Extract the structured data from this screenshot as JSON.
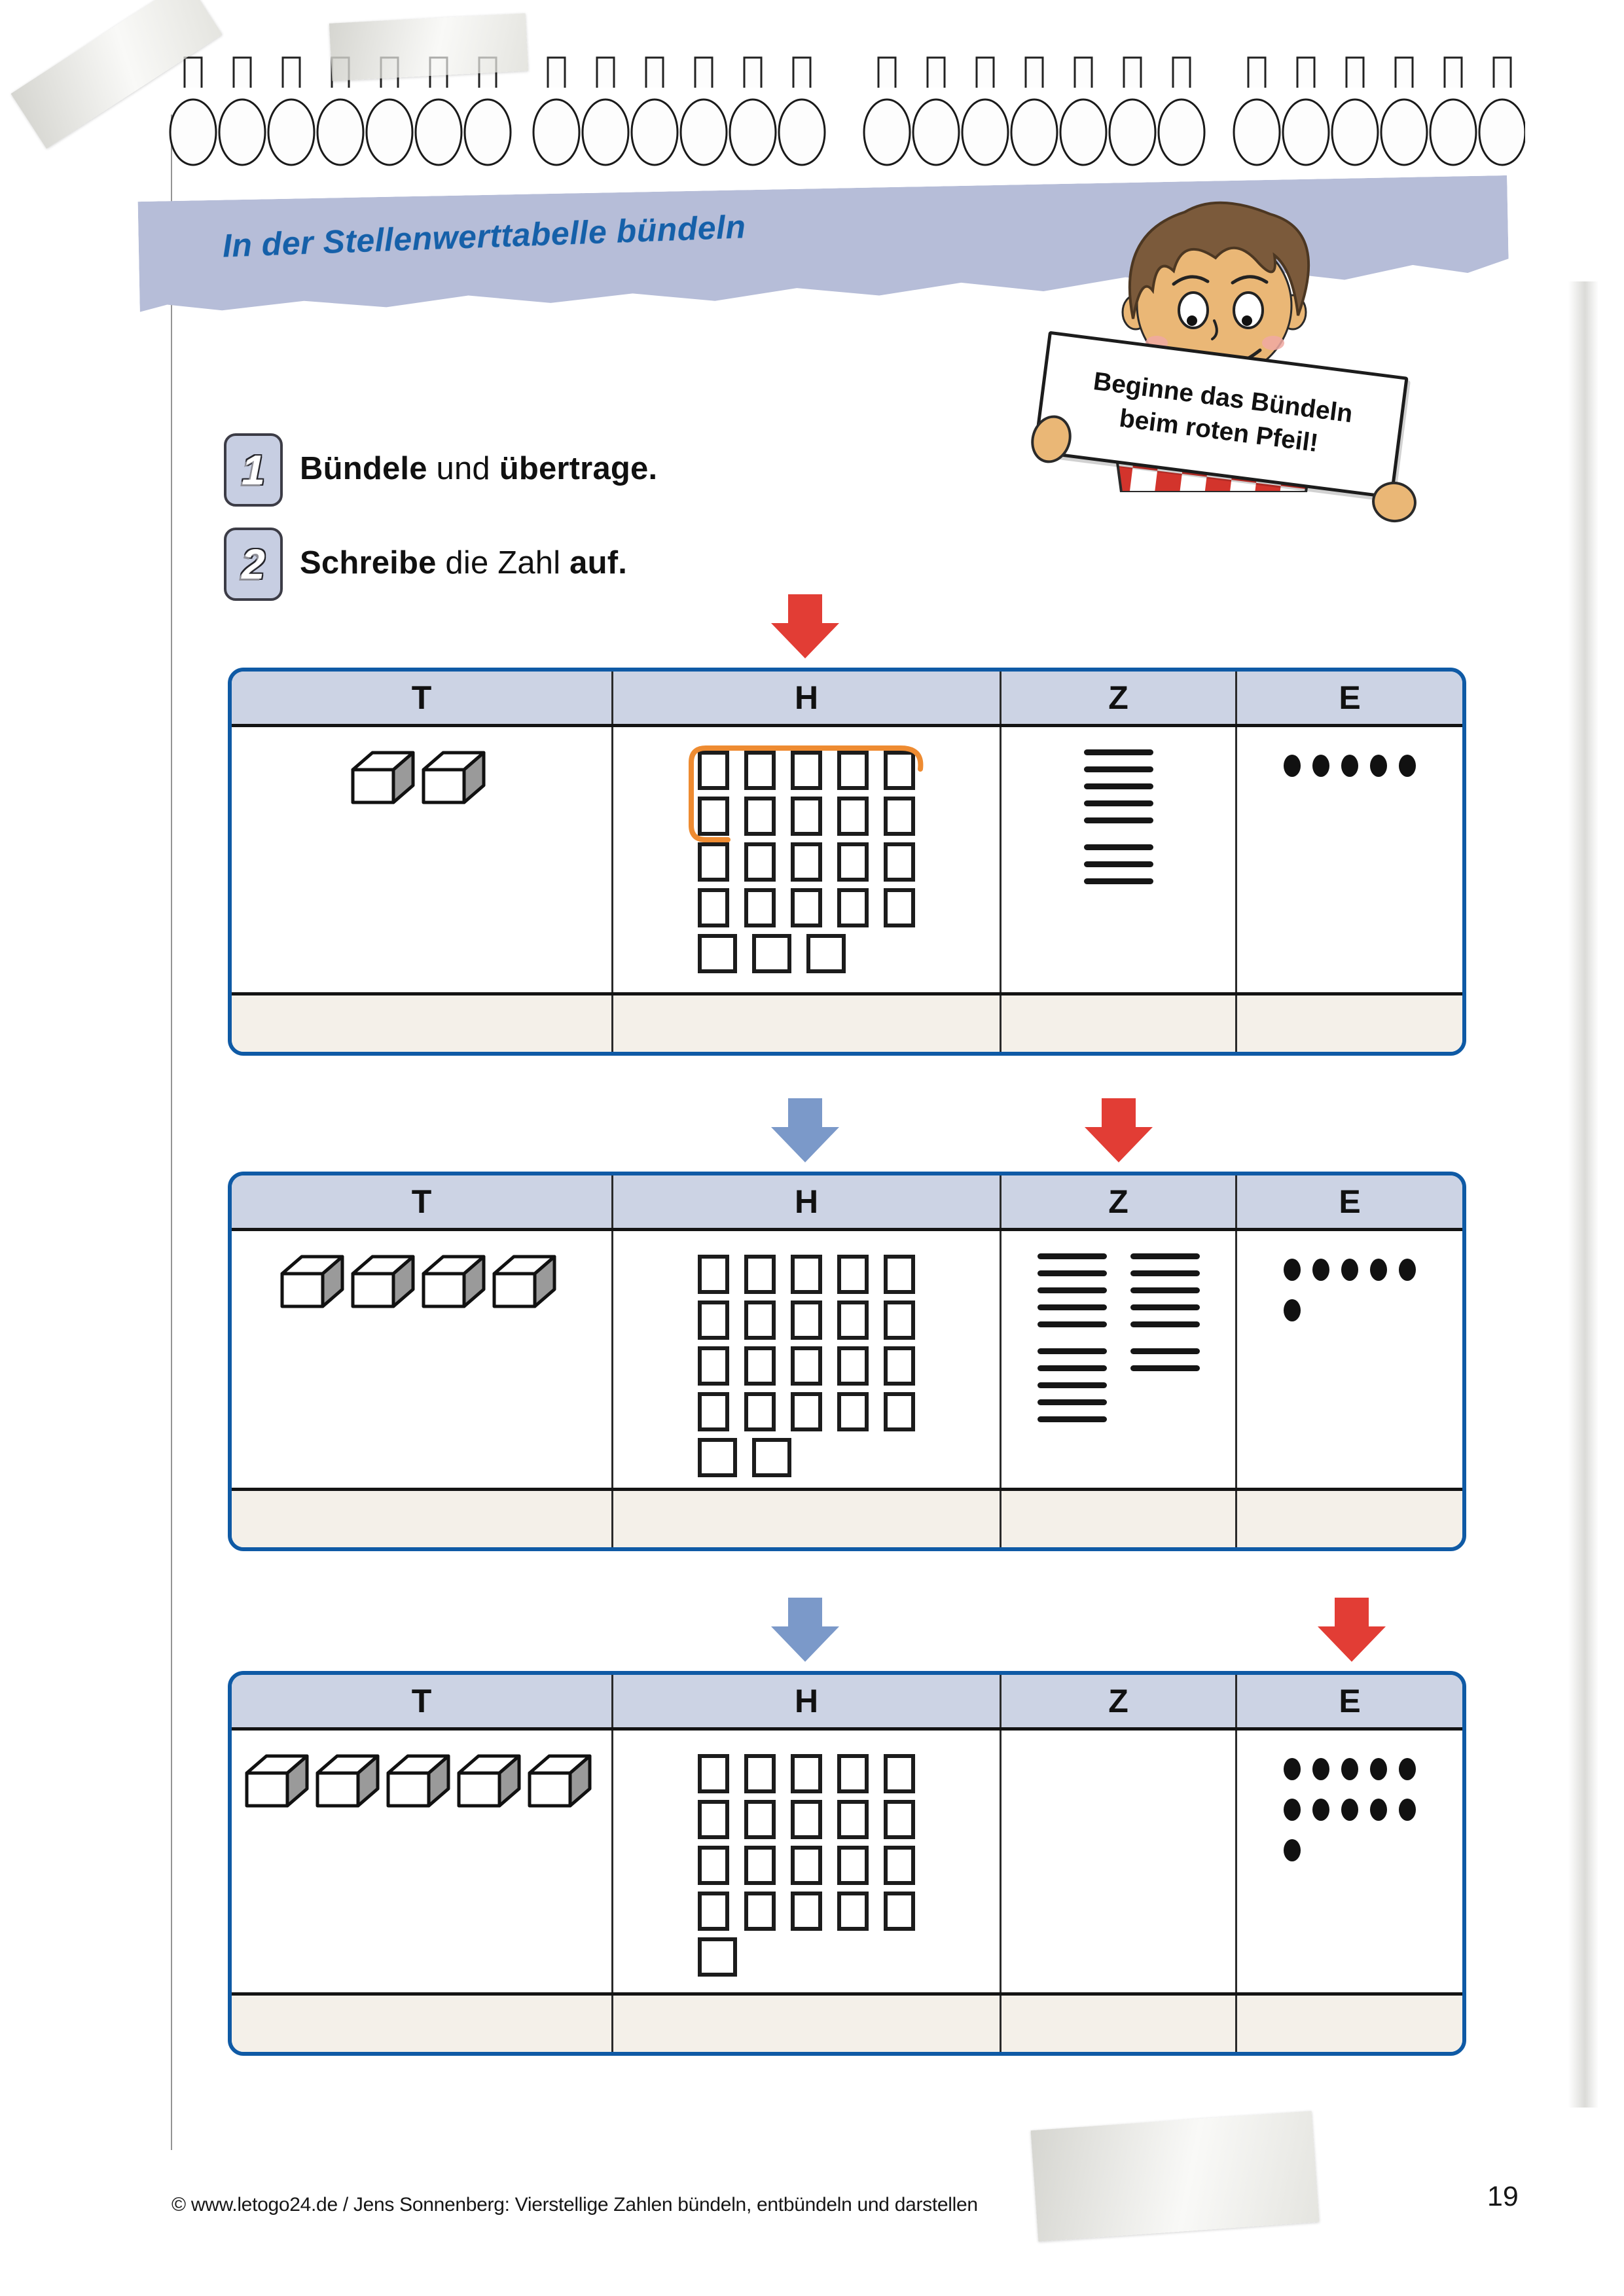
{
  "banner": {
    "title": "In der Stellenwerttabelle bündeln"
  },
  "sign": {
    "line1": "Beginne das Bündeln",
    "line2": "beim roten Pfeil!"
  },
  "instructions": [
    {
      "number": "1",
      "parts": [
        {
          "t": "Bündele",
          "b": 1
        },
        {
          "t": " und ",
          "b": 0
        },
        {
          "t": "übertrage.",
          "b": 1
        }
      ]
    },
    {
      "number": "2",
      "parts": [
        {
          "t": "Schreibe",
          "b": 1
        },
        {
          "t": " die Zahl ",
          "b": 0
        },
        {
          "t": "auf.",
          "b": 1
        }
      ]
    }
  ],
  "tables": [
    {
      "headers": [
        "T",
        "H",
        "Z",
        "E"
      ],
      "arrows": [
        {
          "color": "red",
          "column": "H"
        }
      ],
      "thousands_cubes": 2,
      "hundreds_rows": [
        5,
        5,
        5,
        5,
        3
      ],
      "bundle_highlight": true,
      "tens_line_columns": [
        [
          5,
          3
        ]
      ],
      "ones_dot_rows": [
        5
      ],
      "answers": [
        "",
        "",
        "",
        ""
      ]
    },
    {
      "headers": [
        "T",
        "H",
        "Z",
        "E"
      ],
      "arrows": [
        {
          "color": "blue",
          "column": "H"
        },
        {
          "color": "red",
          "column": "Z"
        }
      ],
      "thousands_cubes": 4,
      "hundreds_rows": [
        5,
        5,
        5,
        5,
        2
      ],
      "bundle_highlight": false,
      "tens_line_columns": [
        [
          5,
          5
        ],
        [
          5,
          2
        ]
      ],
      "ones_dot_rows": [
        5,
        1
      ],
      "answers": [
        "",
        "",
        "",
        ""
      ]
    },
    {
      "headers": [
        "T",
        "H",
        "Z",
        "E"
      ],
      "arrows": [
        {
          "color": "blue",
          "column": "H"
        },
        {
          "color": "red",
          "column": "E"
        }
      ],
      "thousands_cubes": 5,
      "hundreds_rows": [
        5,
        5,
        5,
        5,
        1
      ],
      "bundle_highlight": false,
      "tens_line_columns": [],
      "ones_dot_rows": [
        5,
        5,
        1
      ],
      "answers": [
        "",
        "",
        "",
        ""
      ]
    }
  ],
  "footer": {
    "credit": "© www.letogo24.de / Jens Sonnenberg: Vierstellige Zahlen bündeln, entbündeln und darstellen",
    "page_number": "19"
  },
  "colors": {
    "table_border_blue": "#0f5aa5",
    "header_fill": "#ccd3e4",
    "banner_fill": "#b6bdd8",
    "title_blue": "#1560a9",
    "red_arrow": "#e23d35",
    "blue_arrow": "#7b99c9",
    "bundle_orange": "#ee8b31",
    "answer_row_fill": "#f4f0e9",
    "cube_side_gray": "#9a9a9a",
    "shirt_red": "#d3342c"
  }
}
